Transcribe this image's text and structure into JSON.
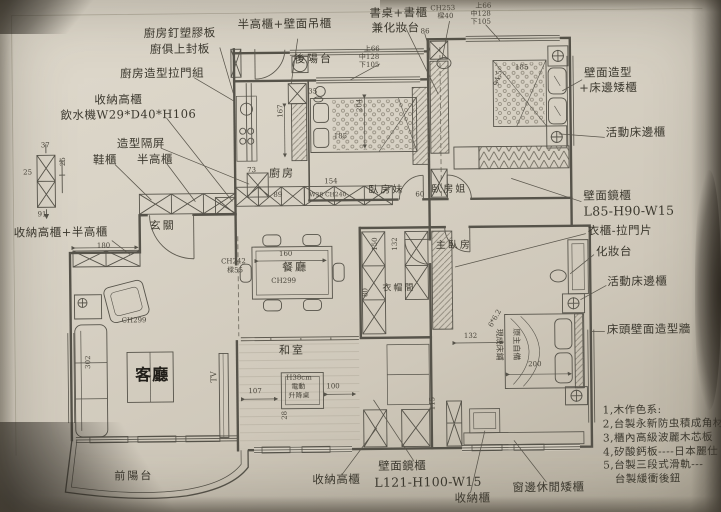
{
  "photo": {
    "paper_color": "#d6d0c3",
    "ink_color": "#56534a",
    "text_color": "#3c392f"
  },
  "plan": {
    "room_labels": [
      {
        "text": "玄關",
        "x": 150,
        "y": 218
      },
      {
        "text": "客廳",
        "x": 134,
        "y": 364,
        "cls": "dark"
      },
      {
        "text": "餐廳",
        "x": 282,
        "y": 261
      },
      {
        "text": "廚房",
        "x": 270,
        "y": 167
      },
      {
        "text": "後陽台",
        "x": 296,
        "y": 53
      },
      {
        "text": "前陽台",
        "x": 112,
        "y": 468
      },
      {
        "text": "和室",
        "x": 278,
        "y": 344
      },
      {
        "text": "臥房妹",
        "x": 369,
        "y": 185,
        "size": 10
      },
      {
        "text": "臥房姐",
        "x": 432,
        "y": 185,
        "size": 10
      },
      {
        "text": "主臥房",
        "x": 436,
        "y": 241,
        "size": 10
      },
      {
        "text": "衣帽間",
        "x": 382,
        "y": 284,
        "size": 9
      }
    ],
    "callout_labels": [
      {
        "text": "廚房釘塑膠板",
        "x": 146,
        "y": 25
      },
      {
        "text": "廚俱上封板",
        "x": 152,
        "y": 41
      },
      {
        "text": "半高櫃+壁面吊櫃",
        "x": 240,
        "y": 17
      },
      {
        "text": "廚房造型拉門組",
        "x": 122,
        "y": 65
      },
      {
        "text": "收納高櫃",
        "x": 96,
        "y": 91
      },
      {
        "text": "飲水機W29*D40*H106",
        "x": 62,
        "y": 106
      },
      {
        "text": "造型隔屏",
        "x": 118,
        "y": 135
      },
      {
        "text": "鞋櫃",
        "x": 94,
        "y": 151
      },
      {
        "text": "半高櫃",
        "x": 138,
        "y": 151
      },
      {
        "text": "收納高櫃+半高櫃",
        "x": 14,
        "y": 223
      },
      {
        "text": "書桌+書櫃",
        "x": 372,
        "y": 7
      },
      {
        "text": "兼化妝台",
        "x": 374,
        "y": 22
      },
      {
        "text": "壁面造型",
        "x": 586,
        "y": 69
      },
      {
        "text": "+床邊矮櫃",
        "x": 581,
        "y": 84
      },
      {
        "text": "活動床邊櫃",
        "x": 607,
        "y": 129
      },
      {
        "text": "壁面鏡櫃",
        "x": 584,
        "y": 192
      },
      {
        "text": "L85-H90-W15",
        "x": 584,
        "y": 207,
        "cls": "latin"
      },
      {
        "text": "衣櫃-拉門片",
        "x": 588,
        "y": 227
      },
      {
        "text": "化妝台",
        "x": 596,
        "y": 248
      },
      {
        "text": "活動床邊櫃",
        "x": 607,
        "y": 278
      },
      {
        "text": "床頭壁面造型牆",
        "x": 606,
        "y": 326
      },
      {
        "text": "收納高櫃",
        "x": 310,
        "y": 473
      },
      {
        "text": "壁面鏡櫃",
        "x": 376,
        "y": 460
      },
      {
        "text": "L121-H100-W15",
        "x": 372,
        "y": 476,
        "cls": "latin"
      },
      {
        "text": "收納櫃",
        "x": 452,
        "y": 493
      },
      {
        "text": "窗邊休閒矮櫃",
        "x": 510,
        "y": 483
      }
    ],
    "dim_labels": [
      {
        "text": "37",
        "x": 42,
        "y": 138
      },
      {
        "text": "25",
        "x": 24,
        "y": 165
      },
      {
        "text": "25",
        "x": 60,
        "y": 163,
        "rot": -90
      },
      {
        "text": "91",
        "x": 38,
        "y": 207
      },
      {
        "text": "180",
        "x": 97,
        "y": 239
      },
      {
        "text": "CH253",
        "x": 433,
        "y": 5
      },
      {
        "text": "樑40",
        "x": 440,
        "y": 13
      },
      {
        "text": "上66",
        "x": 478,
        "y": 3
      },
      {
        "text": "中128",
        "x": 473,
        "y": 11
      },
      {
        "text": "下105",
        "x": 473,
        "y": 19
      },
      {
        "text": "上66",
        "x": 366,
        "y": 45
      },
      {
        "text": "中128",
        "x": 361,
        "y": 53
      },
      {
        "text": "下105",
        "x": 361,
        "y": 61
      },
      {
        "text": "86",
        "x": 423,
        "y": 28
      },
      {
        "text": "35",
        "x": 310,
        "y": 87
      },
      {
        "text": "73",
        "x": 248,
        "y": 165
      },
      {
        "text": "167",
        "x": 278,
        "y": 117,
        "rot": -90
      },
      {
        "text": "204",
        "x": 357,
        "y": 112,
        "rot": -90
      },
      {
        "text": "185",
        "x": 335,
        "y": 132
      },
      {
        "text": "185",
        "x": 517,
        "y": 65
      },
      {
        "text": "94.5",
        "x": 494,
        "y": 86,
        "rot": -75
      },
      {
        "text": "89",
        "x": 274,
        "y": 190
      },
      {
        "text": "154",
        "x": 325,
        "y": 177
      },
      {
        "text": "W38 CH240",
        "x": 310,
        "y": 192,
        "size": 6
      },
      {
        "text": "60",
        "x": 416,
        "y": 191
      },
      {
        "text": "CH242",
        "x": 221,
        "y": 256
      },
      {
        "text": "樑55",
        "x": 227,
        "y": 265
      },
      {
        "text": "160",
        "x": 279,
        "y": 249
      },
      {
        "text": "CH299",
        "x": 271,
        "y": 276
      },
      {
        "text": "CH299",
        "x": 121,
        "y": 314
      },
      {
        "text": "302",
        "x": 83,
        "y": 366,
        "rot": -90
      },
      {
        "text": "150",
        "x": 371,
        "y": 251,
        "rot": -90
      },
      {
        "text": "132",
        "x": 391,
        "y": 251,
        "rot": -90
      },
      {
        "text": "80",
        "x": 361,
        "y": 297,
        "rot": -90
      },
      {
        "text": "132",
        "x": 463,
        "y": 333
      },
      {
        "text": "200",
        "x": 527,
        "y": 362
      },
      {
        "text": "6*6.2",
        "x": 486,
        "y": 326,
        "rot": -60
      },
      {
        "text": "現成床鋪",
        "x": 503,
        "y": 330,
        "rot": 90,
        "size": 8
      },
      {
        "text": "原主自備",
        "x": 520,
        "y": 330,
        "rot": 90,
        "size": 8
      },
      {
        "text": "107",
        "x": 247,
        "y": 386
      },
      {
        "text": "100",
        "x": 325,
        "y": 382
      },
      {
        "text": "28",
        "x": 279,
        "y": 419,
        "rot": -90
      },
      {
        "text": "115",
        "x": 427,
        "y": 411,
        "rot": -90
      },
      {
        "text": "TV",
        "x": 208,
        "y": 381,
        "rot": -90,
        "size": 8
      },
      {
        "text": "H38cm",
        "x": 285,
        "y": 373,
        "size": 7
      },
      {
        "text": "電動",
        "x": 290,
        "y": 382,
        "size": 7
      },
      {
        "text": "升降桌",
        "x": 287,
        "y": 391,
        "size": 7
      }
    ],
    "notes": {
      "x": 601,
      "y": 407,
      "lines": [
        "1,木作色系:",
        "2,台製永新防虫積成角材",
        "3,櫃內高級波麗木芯板",
        "4,矽酸鈣板----日本麗仕",
        "5,台製三段式滑軌---",
        "   台製緩衝後鈕"
      ]
    }
  }
}
